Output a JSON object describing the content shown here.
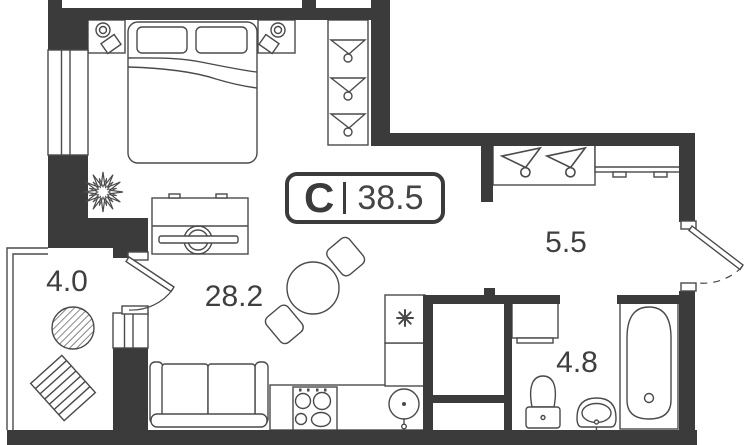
{
  "unit_badge": {
    "type_letter": "С",
    "area_value": "38.5"
  },
  "rooms": {
    "living_room": {
      "area": "28.2"
    },
    "hallway": {
      "area": "5.5"
    },
    "bathroom": {
      "area": "4.8"
    },
    "balcony": {
      "area": "4.0"
    }
  },
  "colors": {
    "wall": "#3b3b3b",
    "outline": "#4a4a4a",
    "background": "#ffffff",
    "label_text": "#3f3f3f"
  },
  "icons": {
    "hanger": "triangle-with-hook-shape",
    "snowflake": "eight-spoke-asterisk-shape",
    "plant": "spiky-star-shape",
    "lamp": "double-circle-shape"
  }
}
